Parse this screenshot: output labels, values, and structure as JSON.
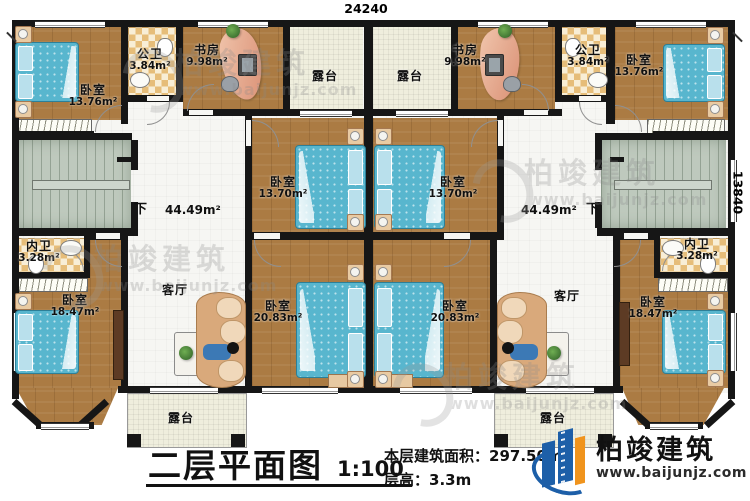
{
  "dimensions": {
    "top": "24240",
    "right": "13840"
  },
  "rooms": {
    "bedroom_tl": {
      "name": "卧室",
      "area": "13.76m²"
    },
    "bath_pub_l": {
      "name": "公卫",
      "area": "3.84m²"
    },
    "study_l": {
      "name": "书房",
      "area": "9.98m²"
    },
    "terrace_top_l": {
      "name": "露台"
    },
    "terrace_top_r": {
      "name": "露台"
    },
    "study_r": {
      "name": "书房",
      "area": "9.98m²"
    },
    "bath_pub_r": {
      "name": "公卫",
      "area": "3.84m²"
    },
    "bedroom_tr": {
      "name": "卧室",
      "area": "13.76m²"
    },
    "bedroom_ml": {
      "name": "卧室",
      "area": "13.70m²"
    },
    "bedroom_mr": {
      "name": "卧室",
      "area": "13.70m²"
    },
    "hall_l": {
      "area": "44.49m²",
      "down": "下"
    },
    "hall_r": {
      "area": "44.49m²",
      "down": "下"
    },
    "bath_priv_l": {
      "name": "内卫",
      "area": "3.28m²"
    },
    "bath_priv_r": {
      "name": "内卫",
      "area": "3.28m²"
    },
    "bedroom_bl": {
      "name": "卧室",
      "area": "18.47m²"
    },
    "bedroom_br": {
      "name": "卧室",
      "area": "18.47m²"
    },
    "living_l": {
      "name": "客厅"
    },
    "living_r": {
      "name": "客厅"
    },
    "bedroom_bcl": {
      "name": "卧室",
      "area": "20.83m²"
    },
    "bedroom_bcr": {
      "name": "卧室",
      "area": "20.83m²"
    },
    "terrace_bot_l": {
      "name": "露台"
    },
    "terrace_bot_r": {
      "name": "露台"
    }
  },
  "title_block": {
    "title": "二层平面图",
    "scale": "1:100",
    "area_label": "本层建筑面积：",
    "area_value": "297.50m²",
    "height_label": "层高：",
    "height_value": "3.3m"
  },
  "logo": {
    "name": "柏竣建筑",
    "url": "www.baijunjz.com"
  },
  "watermark": {
    "name": "柏竣建筑",
    "url": "www.baijunjz.com"
  },
  "colors": {
    "wall": "#161616",
    "wood": "#ab7b43",
    "tile": "#e6bd79",
    "terrace": "#efeedd",
    "stairs": "#bec9bd",
    "bed": "#58b6ce",
    "logo_blue": "#1d5fa8",
    "logo_orange": "#f0941d"
  }
}
